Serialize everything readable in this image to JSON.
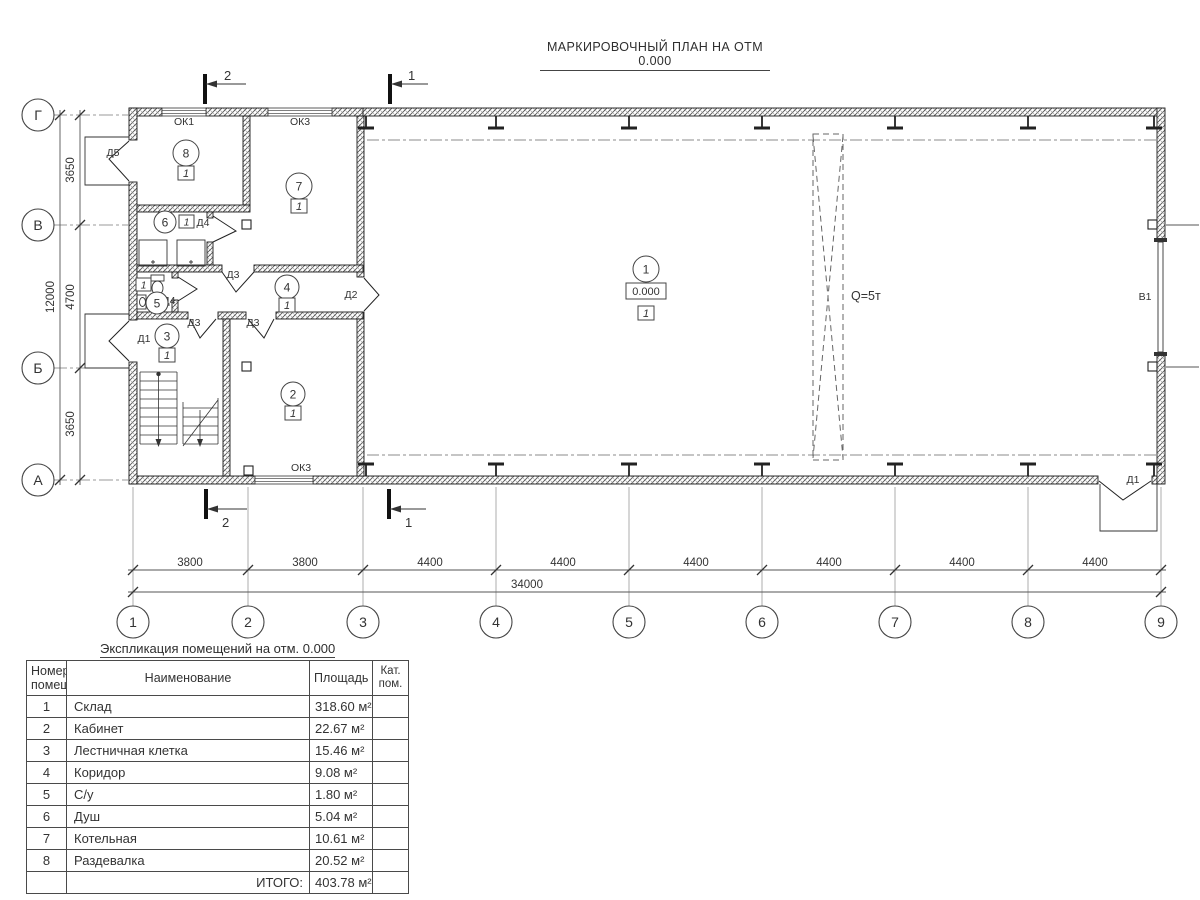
{
  "title": "МАРКИРОВОЧНЫЙ ПЛАН НА ОТМ 0.000",
  "plan": {
    "axes_bottom": [
      "1",
      "2",
      "3",
      "4",
      "5",
      "6",
      "7",
      "8",
      "9"
    ],
    "axes_left": [
      "Г",
      "В",
      "Б",
      "А"
    ],
    "dims_bottom": [
      "3800",
      "3800",
      "4400",
      "4400",
      "4400",
      "4400",
      "4400",
      "4400"
    ],
    "dim_total_bottom": "34000",
    "dims_left": [
      "3650",
      "4700",
      "3650"
    ],
    "dim_total_left": "12000",
    "sections": {
      "s1": "1",
      "s2": "2"
    },
    "rooms": [
      "1",
      "2",
      "3",
      "4",
      "5",
      "6",
      "7",
      "8"
    ],
    "type_mark": "1",
    "elevation": "0.000",
    "crane": "Q=5т",
    "gate": "В1",
    "doors": {
      "d1": "Д1",
      "d2": "Д2",
      "d3": "Д3",
      "d4": "Д4",
      "d5": "Д5"
    },
    "windows": {
      "ok1": "ОК1",
      "ok3": "ОК3"
    }
  },
  "table": {
    "title": "Экспликация помещений на отм. 0.000",
    "headers": {
      "num_l1": "Номер",
      "num_l2": "помещ.",
      "name": "Наименование",
      "area": "Площадь",
      "cat_l1": "Кат.",
      "cat_l2": "пом."
    },
    "rows": [
      {
        "num": "1",
        "name": "Склад",
        "area": "318.60 м²"
      },
      {
        "num": "2",
        "name": "Кабинет",
        "area": "22.67 м²"
      },
      {
        "num": "3",
        "name": "Лестничная клетка",
        "area": "15.46 м²"
      },
      {
        "num": "4",
        "name": "Коридор",
        "area": "9.08 м²"
      },
      {
        "num": "5",
        "name": "С/у",
        "area": "1.80 м²"
      },
      {
        "num": "6",
        "name": "Душ",
        "area": "5.04 м²"
      },
      {
        "num": "7",
        "name": "Котельная",
        "area": "10.61 м²"
      },
      {
        "num": "8",
        "name": "Раздевалка",
        "area": "20.52 м²"
      }
    ],
    "total_label": "ИТОГО:",
    "total_area": "403.78 м²"
  }
}
